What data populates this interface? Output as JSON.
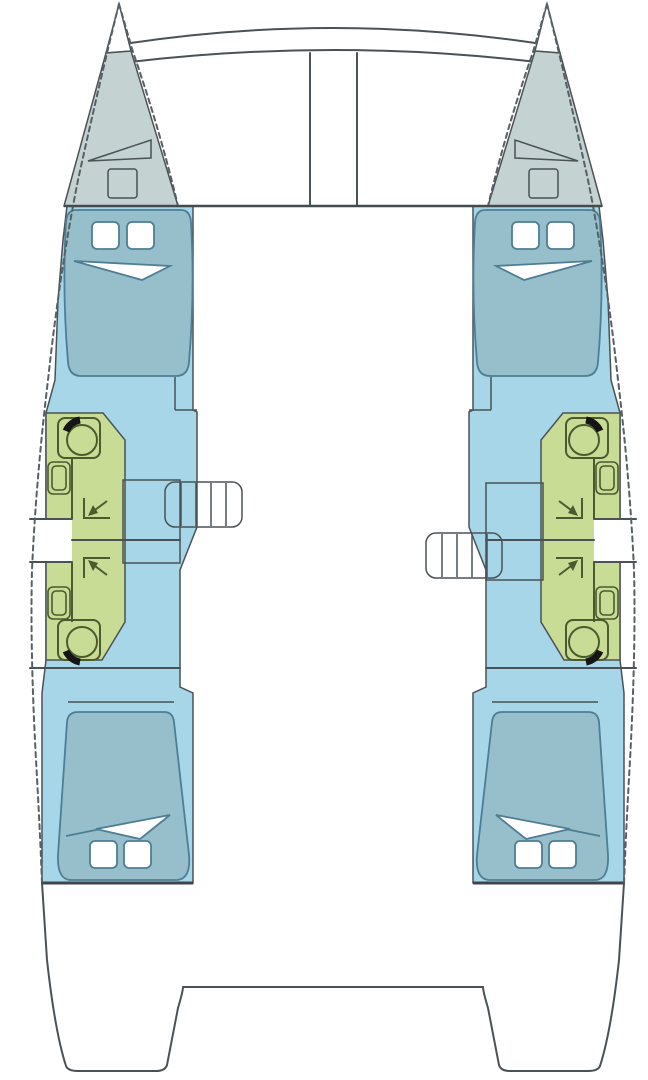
{
  "diagram": {
    "kind": "catamaran-deck-plan",
    "view": "top-down accommodation layout",
    "cabins": 4,
    "heads": 4,
    "port_hull": {
      "foredeck": {
        "fixtures": [
          "sail-locker-vent",
          "deck-hatch"
        ]
      },
      "forward_cabin": {
        "berth": "double-berth",
        "pillows": 2,
        "blanket_fold": true
      },
      "forward_head": {
        "fixtures": [
          "toilet",
          "washbasin",
          "shower-drain-corner"
        ]
      },
      "aft_head": {
        "fixtures": [
          "toilet",
          "washbasin",
          "shower-drain-corner"
        ]
      },
      "side_gate": true,
      "companionway": {
        "treads": 5,
        "position": "forward-of-divider"
      },
      "aft_cabin": {
        "berth": "double-berth",
        "pillows": 2,
        "blanket_fold": true
      }
    },
    "starboard_hull": {
      "foredeck": {
        "fixtures": [
          "sail-locker-vent",
          "deck-hatch"
        ]
      },
      "forward_cabin": {
        "berth": "double-berth",
        "pillows": 2,
        "blanket_fold": true
      },
      "forward_head": {
        "fixtures": [
          "toilet",
          "washbasin",
          "shower-drain-corner"
        ]
      },
      "aft_head": {
        "fixtures": [
          "toilet",
          "washbasin",
          "shower-drain-corner"
        ]
      },
      "side_gate": true,
      "companionway": {
        "treads": 5,
        "position": "aft-of-divider"
      },
      "aft_cabin": {
        "berth": "double-berth",
        "pillows": 2,
        "blanket_fold": true
      }
    },
    "bow_structure": [
      "forward-crossbeam",
      "lower-crossbeam",
      "bowsprit-channel"
    ],
    "stern_structure": [
      "transom-steps-platform"
    ]
  },
  "colors": {
    "white": "#ffffff",
    "foredeck_gray": "#c5d2d2",
    "interior_blue": "#a6d6e8",
    "berth_blue": "#96becb",
    "heads_green": "#c8dc96",
    "stairs_orange": "#f8cb7a",
    "lid_black": "#151515",
    "fixture_stroke": "#4c5a2f"
  }
}
